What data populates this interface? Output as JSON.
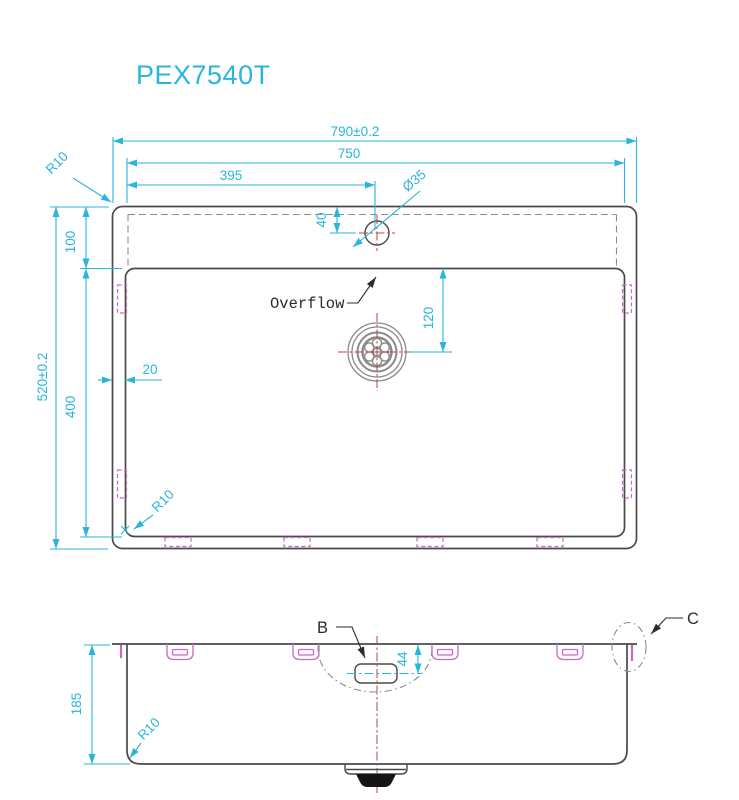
{
  "title": "PEX7540T",
  "colors": {
    "dim": "#2ab5dc",
    "outline": "#4a4a4a",
    "hidden": "#8c8c8c",
    "clip": "#c869c8",
    "centerline": "#bf4341",
    "label": "#2b2b2b"
  },
  "plan_view": {
    "dims": {
      "overall_width": "790±0.2",
      "inner_width": "750",
      "faucet_center_x": "395",
      "faucet_hole_diameter": "Ø35",
      "ledge_depth": "100",
      "overall_depth": "520±0.2",
      "bowl_depth": "400",
      "side_gap": "20",
      "faucet_hole_offset": "40",
      "drain_center_offset": "120",
      "outer_corner_radius": "R10",
      "bowl_corner_radius": "R10"
    },
    "labels": {
      "overflow": "Overflow"
    }
  },
  "front_view": {
    "dims": {
      "height": "185",
      "overflow_center_offset": "44",
      "corner_radius": "R10"
    },
    "labels": {
      "detail_b": "B",
      "detail_c": "C"
    }
  }
}
